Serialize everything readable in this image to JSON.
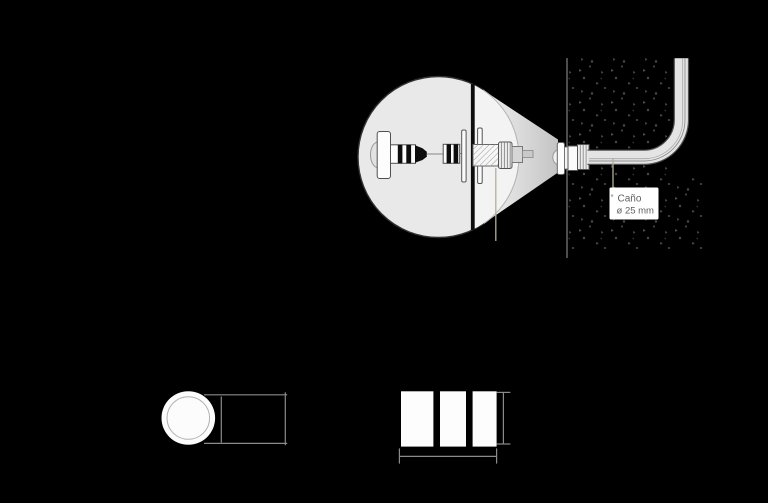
{
  "diagram": {
    "title_hint": "recessed wall light installation detail",
    "labels": {
      "cano": {
        "line1": "Caño",
        "line2": "ø 25 mm"
      }
    }
  },
  "palette": {
    "background": "#000000",
    "detail_circle_fill": "#e9e9e9",
    "detail_circle_outline": "#333333",
    "cone_start": "#f7f7f7",
    "cone_end": "#c4c4c4",
    "part_outline": "#4f4f4f",
    "stripe_black": "#0d0d0d",
    "wall_speckle": "#4f4f4f",
    "wall_face_line": "#8c8c8c",
    "pipe_fill": "#e4e4e4",
    "pipe_outline": "#4f4f4f",
    "pipe_inner_line": "#909090",
    "leader": "#b3ae9a",
    "label_bg": "#ffffff",
    "label_text": "#5f5f5f",
    "dimension_line": "#8a8a8a",
    "front_view_fill": "#fcfcfc",
    "front_view_ring": "#b0b0b0"
  }
}
